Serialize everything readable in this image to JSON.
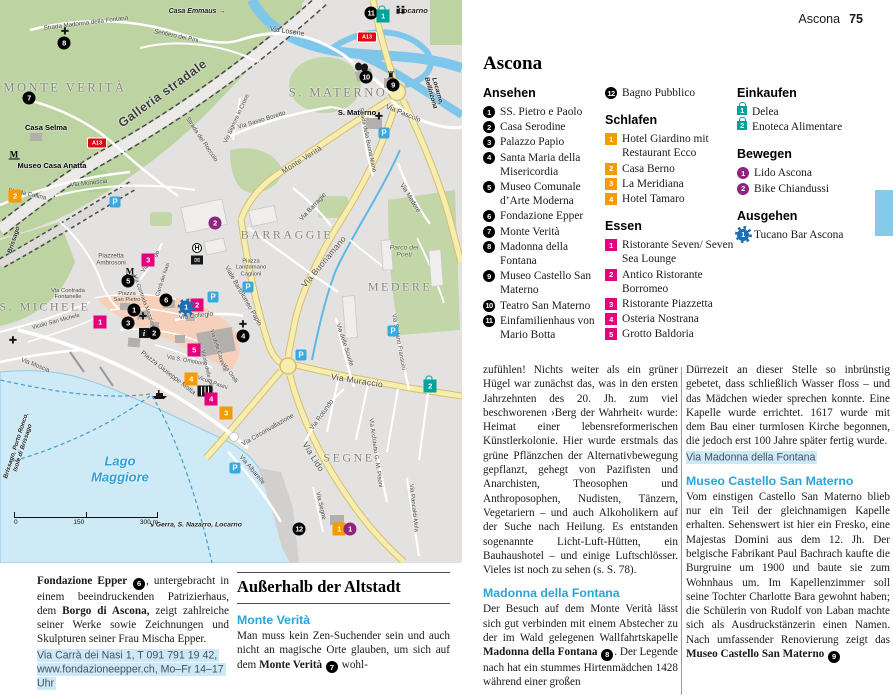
{
  "header": {
    "section": "Ascona",
    "page": "75"
  },
  "title": "Ascona",
  "legend": {
    "columns": [
      {
        "blocks": [
          {
            "heading": "Ansehen",
            "cat": "sight",
            "items": [
              {
                "n": "1",
                "label": "SS. Pietro e Paolo"
              },
              {
                "n": "2",
                "label": "Casa Serodine"
              },
              {
                "n": "3",
                "label": "Palazzo Papio"
              },
              {
                "n": "4",
                "label": "Santa Maria della Misericordia"
              },
              {
                "n": "5",
                "label": "Museo Comunale d’Arte Moderna"
              },
              {
                "n": "6",
                "label": "Fondazione Epper"
              },
              {
                "n": "7",
                "label": "Monte Verità"
              },
              {
                "n": "8",
                "label": "Madonna della Fontana"
              },
              {
                "n": "9",
                "label": "Museo Castello San Materno"
              },
              {
                "n": "10",
                "label": "Teatro San Materno"
              },
              {
                "n": "11",
                "label": "Einfamilienhaus von Mario Botta"
              }
            ]
          }
        ]
      },
      {
        "blocks": [
          {
            "heading": null,
            "cat": "sight",
            "items": [
              {
                "n": "12",
                "label": "Bagno Pubblico"
              }
            ]
          },
          {
            "heading": "Schlafen",
            "cat": "hotel",
            "items": [
              {
                "n": "1",
                "label": "Hotel Giardino mit Restaurant Ecco"
              },
              {
                "n": "2",
                "label": "Casa Berno"
              },
              {
                "n": "3",
                "label": "La Meridiana"
              },
              {
                "n": "4",
                "label": "Hotel Tamaro"
              }
            ]
          },
          {
            "heading": "Essen",
            "cat": "food",
            "items": [
              {
                "n": "1",
                "label": "Ristorante Seven/ Seven Sea Lounge"
              },
              {
                "n": "2",
                "label": "Antico Ristorante Borromeo"
              },
              {
                "n": "3",
                "label": "Ristorante Piazzetta"
              },
              {
                "n": "4",
                "label": "Osteria Nostrana"
              },
              {
                "n": "5",
                "label": "Grotto Baldoria"
              }
            ]
          }
        ]
      },
      {
        "blocks": [
          {
            "heading": "Einkaufen",
            "cat": "shop",
            "items": [
              {
                "n": "1",
                "label": "Delea"
              },
              {
                "n": "2",
                "label": "Enoteca Alimentare"
              }
            ]
          },
          {
            "heading": "Bewegen",
            "cat": "move",
            "items": [
              {
                "n": "1",
                "label": "Lido Ascona"
              },
              {
                "n": "2",
                "label": "Bike Chiandussi"
              }
            ]
          },
          {
            "heading": "Ausgehen",
            "cat": "night",
            "items": [
              {
                "n": "1",
                "label": "Tucano Bar Ascona"
              }
            ]
          }
        ]
      }
    ]
  },
  "articles": {
    "colA": [
      {
        "p": [
          {
            "t": "zufühlen! Nichts weiter als ein grüner Hügel war zunächst das, was in den ersten Jahrzehnten des 20. Jh. zum viel beschworenen ›Berg der Wahrheit‹ wurde: Heimat einer lebensreformerischen Künstlerkolonie. Hier wurde erstmals das grüne Pflänzchen der Alternativbewegung gepflanzt, gehegt von Pazifisten und Anarchisten, Theosophen und Anthroposophen, Nudisten, Tänzern, Vegetariern – und auch Alkoholikern auf der Suche nach Heilung. Es entstanden sogenannte Licht-Luft-Hütten, ein Bauhaushotel – und einige Luftschlösser. Vieles ist noch zu sehen (s. S. 78)."
          }
        ]
      },
      {
        "h": "Madonna della Fontana"
      },
      {
        "p": [
          {
            "t": "Der Besuch auf dem Monte Verità lässt sich gut verbinden mit einem Abstecher zu der im Wald gelegenen Wallfahrtskapelle "
          },
          {
            "t": "Madonna della Fontana ",
            "b": true
          },
          {
            "m": "8"
          },
          {
            "t": ". Der Legende nach hat ein stummes Hirtenmädchen 1428 während einer großen"
          }
        ]
      }
    ],
    "colB": [
      {
        "p": [
          {
            "t": "Dürrezeit an dieser Stelle so inbrünstig gebetet, dass schließlich Wasser floss – und das Mädchen wieder sprechen konnte. Eine Kapelle wurde errichtet. 1617 wurde mit dem Bau einer turmlosen Kirche begonnen, die jedoch erst 100 Jahre später fertig wurde."
          }
        ]
      },
      {
        "addr": "Via Madonna della Fontana"
      },
      {
        "h": "Museo Castello San Materno"
      },
      {
        "p": [
          {
            "t": "Vom einstigen Castello San Materno blieb nur ein Teil der gleichnamigen Kapelle erhalten. Sehenswert ist hier ein Fresko, eine Majestas Domini aus dem 12. Jh. Der belgische Fabrikant Paul Bachrach kaufte die Burgruine um 1900 und baute sie zum Wohnhaus um. Im Kapellenzimmer soll seine Tochter Charlotte Bara gewohnt haben; die Schülerin von Rudolf von Laban machte sich als Ausdruckstänzerin einen Namen. Nach umfassender Renovierung zeigt das "
          },
          {
            "t": "Museo Castello San Materno ",
            "b": true
          },
          {
            "m": "9"
          }
        ]
      }
    ],
    "fondazione": [
      {
        "p": [
          {
            "t": "Fondazione Epper ",
            "b": true
          },
          {
            "m": "6"
          },
          {
            "t": ", untergebracht in einem beeindruckenden Patrizierhaus, dem "
          },
          {
            "t": "Borgo di Ascona,",
            "b": true
          },
          {
            "t": " zeigt zahlreiche seiner Werke sowie Zeichnungen und Skulpturen seiner Frau Mischa Epper."
          }
        ]
      },
      {
        "addr": "Via Carrà dei Nasi 1, T 091 791 19 42, www.fondazioneepper.ch, Mo–Fr 14–17 Uhr"
      }
    ],
    "outside": [
      {
        "title": "Außerhalb der Altstadt"
      },
      {
        "h": "Monte Verità"
      },
      {
        "p": [
          {
            "t": "Man muss kein Zen-Suchender sein und auch nicht an magische Orte glauben, um sich auf dem "
          },
          {
            "t": "Monte Verità ",
            "b": true
          },
          {
            "m": "7"
          },
          {
            "t": " wohl-"
          }
        ]
      }
    ]
  },
  "map": {
    "labels": [
      {
        "t": "MONTE VERITÀ",
        "x": 65,
        "y": 88,
        "s": 12.5,
        "c": "area"
      },
      {
        "t": "S. MATERNO",
        "x": 338,
        "y": 93,
        "s": 12.5,
        "c": "area"
      },
      {
        "t": "BARRAGGIE",
        "x": 287,
        "y": 235,
        "s": 12,
        "c": "area"
      },
      {
        "t": "MEDERE",
        "x": 400,
        "y": 287,
        "s": 12,
        "c": "area"
      },
      {
        "t": "SEGNE",
        "x": 349,
        "y": 458,
        "s": 12,
        "c": "area"
      },
      {
        "t": "S. MICHELE",
        "x": 45,
        "y": 307,
        "s": 12,
        "c": "area"
      },
      {
        "t": "Lago\nMaggiore",
        "x": 120,
        "y": 469,
        "s": 13,
        "c": "water"
      },
      {
        "t": "Galleria stradale",
        "x": 163,
        "y": 94,
        "r": -36,
        "s": 12.5,
        "c": "big"
      },
      {
        "t": "Strada Madonna della Fontana",
        "x": 86,
        "y": 24,
        "r": -7,
        "s": 6.2,
        "c": "street"
      },
      {
        "t": "Casa Emmaus →",
        "x": 197,
        "y": 12,
        "s": 7,
        "c": "dest"
      },
      {
        "t": "Sentiero dei Pini",
        "x": 176,
        "y": 37,
        "r": 12,
        "s": 6.2,
        "c": "street"
      },
      {
        "t": "Locarno",
        "x": 413,
        "y": 11,
        "s": 7.5,
        "c": "dest"
      },
      {
        "t": "Via Losone",
        "x": 287,
        "y": 32,
        "r": 9,
        "s": 7,
        "c": "street"
      },
      {
        "t": "Strada del Roccolo",
        "x": 201,
        "y": 140,
        "r": 56,
        "s": 6.2,
        "c": "street"
      },
      {
        "t": "Via Sasso Boretto",
        "x": 262,
        "y": 121,
        "r": -17,
        "s": 6.2,
        "c": "street"
      },
      {
        "t": "Via Signore in Croce",
        "x": 237,
        "y": 119,
        "r": -65,
        "s": 5.8,
        "c": "street"
      },
      {
        "t": "Monte Verità",
        "x": 302,
        "y": 160,
        "r": -32,
        "s": 7.5,
        "c": "big2"
      },
      {
        "t": "S. Materno",
        "x": 357,
        "y": 113,
        "s": 7.5,
        "c": "poi"
      },
      {
        "t": "Via Pascolo",
        "x": 403,
        "y": 114,
        "r": 22,
        "s": 7,
        "c": "street"
      },
      {
        "t": "Strada della Buona Mano",
        "x": 367,
        "y": 140,
        "r": 78,
        "s": 5.8,
        "c": "street"
      },
      {
        "t": "Locarno, Bellinzona",
        "x": 434,
        "y": 92,
        "r": 74,
        "s": 6.5,
        "c": "dest"
      },
      {
        "t": "Casa Selma",
        "x": 46,
        "y": 128,
        "s": 7.5,
        "c": "poi"
      },
      {
        "t": "Museo Casa Anatta",
        "x": 52,
        "y": 166,
        "s": 7.5,
        "c": "poi"
      },
      {
        "t": "Strada Collina",
        "x": 27,
        "y": 195,
        "r": 12,
        "s": 6.2,
        "c": "street"
      },
      {
        "t": "Via Monescia",
        "x": 89,
        "y": 184,
        "r": -6,
        "s": 6.2,
        "c": "street"
      },
      {
        "t": "Brissago",
        "x": 14,
        "y": 240,
        "r": -72,
        "s": 6.5,
        "c": "dest"
      },
      {
        "t": "Via Moscia",
        "x": 35,
        "y": 366,
        "r": 22,
        "s": 6.2,
        "c": "street"
      },
      {
        "t": "Piazzetta\nAmbrosoni",
        "x": 111,
        "y": 260,
        "s": 6.2,
        "c": "street"
      },
      {
        "t": "Via Contrada\nFontanelle",
        "x": 68,
        "y": 294,
        "s": 5.8,
        "c": "street"
      },
      {
        "t": "Piazza\nSan Pietro",
        "x": 127,
        "y": 297,
        "s": 5.8,
        "c": "street"
      },
      {
        "t": "Via Borgo",
        "x": 151,
        "y": 262,
        "r": -52,
        "s": 6,
        "c": "street"
      },
      {
        "t": "Carrà dei Nasi",
        "x": 164,
        "y": 280,
        "r": -72,
        "s": 5.5,
        "c": "street"
      },
      {
        "t": "Via Contrada Maggiore",
        "x": 143,
        "y": 302,
        "r": 70,
        "s": 5.5,
        "c": "street"
      },
      {
        "t": "Via Collegio",
        "x": 196,
        "y": 316,
        "r": -6,
        "s": 6.5,
        "c": "street"
      },
      {
        "t": "Viale Bartolomeo Papio",
        "x": 243,
        "y": 296,
        "r": 60,
        "s": 6.5,
        "c": "street"
      },
      {
        "t": "Via Barragie",
        "x": 313,
        "y": 207,
        "r": -47,
        "s": 6.5,
        "c": "street"
      },
      {
        "t": "Via Buonamano",
        "x": 324,
        "y": 262,
        "r": -50,
        "s": 8.5,
        "c": "big2"
      },
      {
        "t": "Via Medere",
        "x": 410,
        "y": 198,
        "r": 58,
        "s": 6.5,
        "c": "street"
      },
      {
        "t": "Parco dei\nPoeti",
        "x": 404,
        "y": 252,
        "s": 6.8,
        "c": "park"
      },
      {
        "t": "Piazza\nLandamano\nCaglioni",
        "x": 251,
        "y": 268,
        "s": 5.8,
        "c": "street"
      },
      {
        "t": "Vicolo San Michele",
        "x": 56,
        "y": 322,
        "r": -15,
        "s": 5.8,
        "c": "street"
      },
      {
        "t": "Piazza Giuseppe Motta",
        "x": 168,
        "y": 373,
        "r": 38,
        "s": 6.5,
        "c": "street"
      },
      {
        "t": "Via S. Omobono",
        "x": 187,
        "y": 361,
        "r": 10,
        "s": 5.6,
        "c": "street"
      },
      {
        "t": "Vicolo delle Olive",
        "x": 206,
        "y": 371,
        "r": 77,
        "s": 5.5,
        "c": "street"
      },
      {
        "t": "Via delle Cappelle",
        "x": 217,
        "y": 351,
        "r": 72,
        "s": 5.5,
        "c": "street"
      },
      {
        "t": "Vicolo Pasini",
        "x": 212,
        "y": 384,
        "r": 20,
        "s": 5.5,
        "c": "street"
      },
      {
        "t": "Via Orelli",
        "x": 229,
        "y": 374,
        "r": 55,
        "s": 5.5,
        "c": "street"
      },
      {
        "t": "Via delle Scuole",
        "x": 344,
        "y": 345,
        "r": 72,
        "s": 6.2,
        "c": "street"
      },
      {
        "t": "Via Stefano Franscini",
        "x": 398,
        "y": 342,
        "r": 80,
        "s": 6,
        "c": "street"
      },
      {
        "t": "Via Muraccio",
        "x": 357,
        "y": 381,
        "r": 9,
        "s": 8.5,
        "c": "big2"
      },
      {
        "t": "Via Rotundo",
        "x": 322,
        "y": 415,
        "r": -54,
        "s": 6.5,
        "c": "street"
      },
      {
        "t": "Via Circonvallazione",
        "x": 268,
        "y": 430,
        "r": -30,
        "s": 6.5,
        "c": "street"
      },
      {
        "t": "Via Lido",
        "x": 313,
        "y": 457,
        "r": 58,
        "s": 8.5,
        "c": "big2"
      },
      {
        "t": "Via Albarelle",
        "x": 252,
        "y": 470,
        "r": 50,
        "s": 6.5,
        "c": "street"
      },
      {
        "t": "Via Segne",
        "x": 320,
        "y": 506,
        "r": 77,
        "s": 6.2,
        "c": "street"
      },
      {
        "t": "Via Architetto G. M. Pisoni",
        "x": 375,
        "y": 453,
        "r": 82,
        "s": 6,
        "c": "street"
      },
      {
        "t": "Via Pancaldi-Mola",
        "x": 413,
        "y": 508,
        "r": 84,
        "s": 6,
        "c": "street"
      },
      {
        "t": "Brissago, Porto Ronco,\nIsole di Brissago",
        "x": 20,
        "y": 447,
        "r": -72,
        "s": 6.2,
        "c": "dest"
      },
      {
        "t": "↘ Gerra, S. Nazarro, Locarno",
        "x": 195,
        "y": 525,
        "s": 6.8,
        "c": "dest"
      }
    ],
    "markers": [
      {
        "c": "sight",
        "n": "1",
        "x": 134,
        "y": 310
      },
      {
        "c": "sight",
        "n": "2",
        "x": 154,
        "y": 333
      },
      {
        "c": "sight",
        "n": "3",
        "x": 128,
        "y": 323
      },
      {
        "c": "sight",
        "n": "4",
        "x": 243,
        "y": 336
      },
      {
        "c": "sight",
        "n": "5",
        "x": 128,
        "y": 281
      },
      {
        "c": "sight",
        "n": "6",
        "x": 166,
        "y": 300
      },
      {
        "c": "sight",
        "n": "7",
        "x": 29,
        "y": 98
      },
      {
        "c": "sight",
        "n": "8",
        "x": 64,
        "y": 43
      },
      {
        "c": "sight",
        "n": "9",
        "x": 393,
        "y": 85
      },
      {
        "c": "sight",
        "n": "10",
        "x": 366,
        "y": 77
      },
      {
        "c": "sight",
        "n": "11",
        "x": 371,
        "y": 13
      },
      {
        "c": "sight",
        "n": "12",
        "x": 299,
        "y": 529
      },
      {
        "c": "hotel",
        "n": "1",
        "x": 339,
        "y": 529
      },
      {
        "c": "hotel",
        "n": "2",
        "x": 15,
        "y": 196
      },
      {
        "c": "hotel",
        "n": "3",
        "x": 226,
        "y": 413
      },
      {
        "c": "hotel",
        "n": "4",
        "x": 191,
        "y": 379
      },
      {
        "c": "food",
        "n": "1",
        "x": 100,
        "y": 322
      },
      {
        "c": "food",
        "n": "2",
        "x": 197,
        "y": 305
      },
      {
        "c": "food",
        "n": "3",
        "x": 148,
        "y": 260
      },
      {
        "c": "food",
        "n": "4",
        "x": 211,
        "y": 399
      },
      {
        "c": "food",
        "n": "5",
        "x": 194,
        "y": 350
      },
      {
        "c": "shop",
        "n": "1",
        "x": 383,
        "y": 13
      },
      {
        "c": "shop",
        "n": "2",
        "x": 430,
        "y": 383
      },
      {
        "c": "move",
        "n": "1",
        "x": 350,
        "y": 529
      },
      {
        "c": "move",
        "n": "2",
        "x": 215,
        "y": 223
      },
      {
        "c": "night",
        "n": "1",
        "x": 186,
        "y": 307
      }
    ],
    "icons": [
      {
        "t": "parking",
        "x": 115,
        "y": 202
      },
      {
        "t": "parking",
        "x": 213,
        "y": 297
      },
      {
        "t": "parking",
        "x": 384,
        "y": 133
      },
      {
        "t": "parking",
        "x": 248,
        "y": 287
      },
      {
        "t": "parking",
        "x": 301,
        "y": 355
      },
      {
        "t": "parking",
        "x": 235,
        "y": 468
      },
      {
        "t": "parking",
        "x": 393,
        "y": 331
      },
      {
        "t": "a13",
        "x": 97,
        "y": 143
      },
      {
        "t": "a13",
        "x": 367,
        "y": 37
      },
      {
        "t": "church",
        "x": 65,
        "y": 32
      },
      {
        "t": "church",
        "x": 143,
        "y": 317
      },
      {
        "t": "church",
        "x": 243,
        "y": 325
      },
      {
        "t": "church",
        "x": 13,
        "y": 341
      },
      {
        "t": "church",
        "x": 379,
        "y": 117
      },
      {
        "t": "museum",
        "x": 14,
        "y": 155
      },
      {
        "t": "museum",
        "x": 130,
        "y": 272
      },
      {
        "t": "hotelH",
        "x": 197,
        "y": 248
      },
      {
        "t": "mail",
        "x": 197,
        "y": 260
      },
      {
        "t": "info",
        "x": 144,
        "y": 333
      },
      {
        "t": "library",
        "x": 205,
        "y": 391
      },
      {
        "t": "castle",
        "x": 391,
        "y": 76
      },
      {
        "t": "theater",
        "x": 362,
        "y": 67
      },
      {
        "t": "ferry",
        "x": 152,
        "y": 390
      },
      {
        "t": "people",
        "x": 398,
        "y": 11
      }
    ],
    "scale": {
      "labels": [
        "0",
        "150",
        "300 m"
      ]
    }
  }
}
